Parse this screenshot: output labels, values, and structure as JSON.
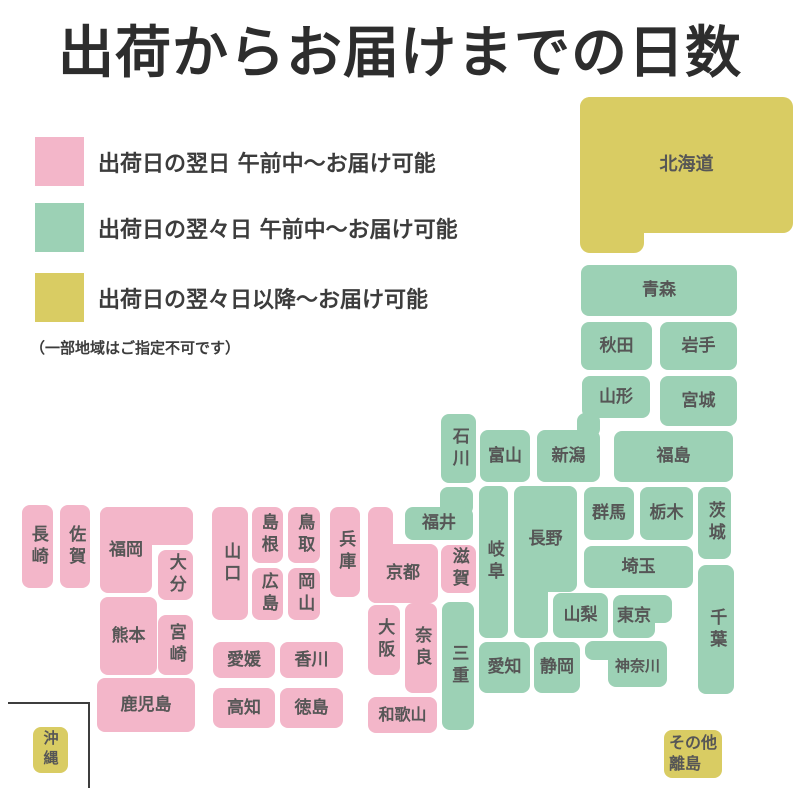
{
  "title": "出荷からお届けまでの日数",
  "legend": {
    "items": [
      {
        "key": "pink",
        "label": "出荷日の翌日 午前中〜お届け可能"
      },
      {
        "key": "green",
        "label": "出荷日の翌々日 午前中〜お届け可能"
      },
      {
        "key": "yellow",
        "label": "出荷日の翌々日以降〜お届け可能"
      }
    ],
    "note": "（一部地域はご指定不可です）"
  },
  "colors": {
    "pink": "#f3b6c9",
    "green": "#9cd1b5",
    "yellow": "#d9cc63",
    "title_text": "#2d2d2d",
    "legend_text": "#3c3c3c",
    "block_label": "#565656",
    "okinawa_box_line": "#3d3d3d"
  },
  "prefs": {
    "hokkaido": {
      "label": "北海道",
      "group": "yellow"
    },
    "aomori": {
      "label": "青森",
      "group": "green"
    },
    "akita": {
      "label": "秋田",
      "group": "green"
    },
    "iwate": {
      "label": "岩手",
      "group": "green"
    },
    "yamagata": {
      "label": "山形",
      "group": "green"
    },
    "miyagi": {
      "label": "宮城",
      "group": "green"
    },
    "fukushima": {
      "label": "福島",
      "group": "green"
    },
    "niigata": {
      "label": "新潟",
      "group": "green"
    },
    "toyama": {
      "label": "富山",
      "group": "green"
    },
    "ishikawa": {
      "label": "石川",
      "group": "green"
    },
    "fukui": {
      "label": "福井",
      "group": "green"
    },
    "gunma": {
      "label": "群馬",
      "group": "green"
    },
    "tochigi": {
      "label": "栃木",
      "group": "green"
    },
    "ibaraki": {
      "label": "茨城",
      "group": "green"
    },
    "saitama": {
      "label": "埼玉",
      "group": "green"
    },
    "chiba": {
      "label": "千葉",
      "group": "green"
    },
    "yamanashi": {
      "label": "山梨",
      "group": "green"
    },
    "tokyo": {
      "label": "東京",
      "group": "green"
    },
    "kanagawa": {
      "label": "神奈川",
      "group": "green"
    },
    "nagano": {
      "label": "長野",
      "group": "green"
    },
    "gifu": {
      "label": "岐阜",
      "group": "green"
    },
    "shizuoka": {
      "label": "静岡",
      "group": "green"
    },
    "aichi": {
      "label": "愛知",
      "group": "green"
    },
    "mie": {
      "label": "三重",
      "group": "green"
    },
    "shiga": {
      "label": "滋賀",
      "group": "pink"
    },
    "kyoto": {
      "label": "京都",
      "group": "pink"
    },
    "osaka": {
      "label": "大阪",
      "group": "pink"
    },
    "nara": {
      "label": "奈良",
      "group": "pink"
    },
    "wakayama": {
      "label": "和歌山",
      "group": "pink"
    },
    "hyogo": {
      "label": "兵庫",
      "group": "pink"
    },
    "tottori": {
      "label": "鳥取",
      "group": "pink"
    },
    "shimane": {
      "label": "島根",
      "group": "pink"
    },
    "okayama": {
      "label": "岡山",
      "group": "pink"
    },
    "hiroshima": {
      "label": "広島",
      "group": "pink"
    },
    "yamaguchi": {
      "label": "山口",
      "group": "pink"
    },
    "kagawa": {
      "label": "香川",
      "group": "pink"
    },
    "ehime": {
      "label": "愛媛",
      "group": "pink"
    },
    "tokushima": {
      "label": "徳島",
      "group": "pink"
    },
    "kochi": {
      "label": "高知",
      "group": "pink"
    },
    "fukuoka": {
      "label": "福岡",
      "group": "pink"
    },
    "oita": {
      "label": "大分",
      "group": "pink"
    },
    "kumamoto": {
      "label": "熊本",
      "group": "pink"
    },
    "miyazaki": {
      "label": "宮崎",
      "group": "pink"
    },
    "nagasaki": {
      "label": "長崎",
      "group": "pink"
    },
    "saga": {
      "label": "佐賀",
      "group": "pink"
    },
    "kagoshima": {
      "label": "鹿児島",
      "group": "pink"
    },
    "okinawa": {
      "label": "沖縄",
      "group": "yellow"
    },
    "sonota": {
      "label": "その他\n離島",
      "group": "yellow"
    }
  }
}
